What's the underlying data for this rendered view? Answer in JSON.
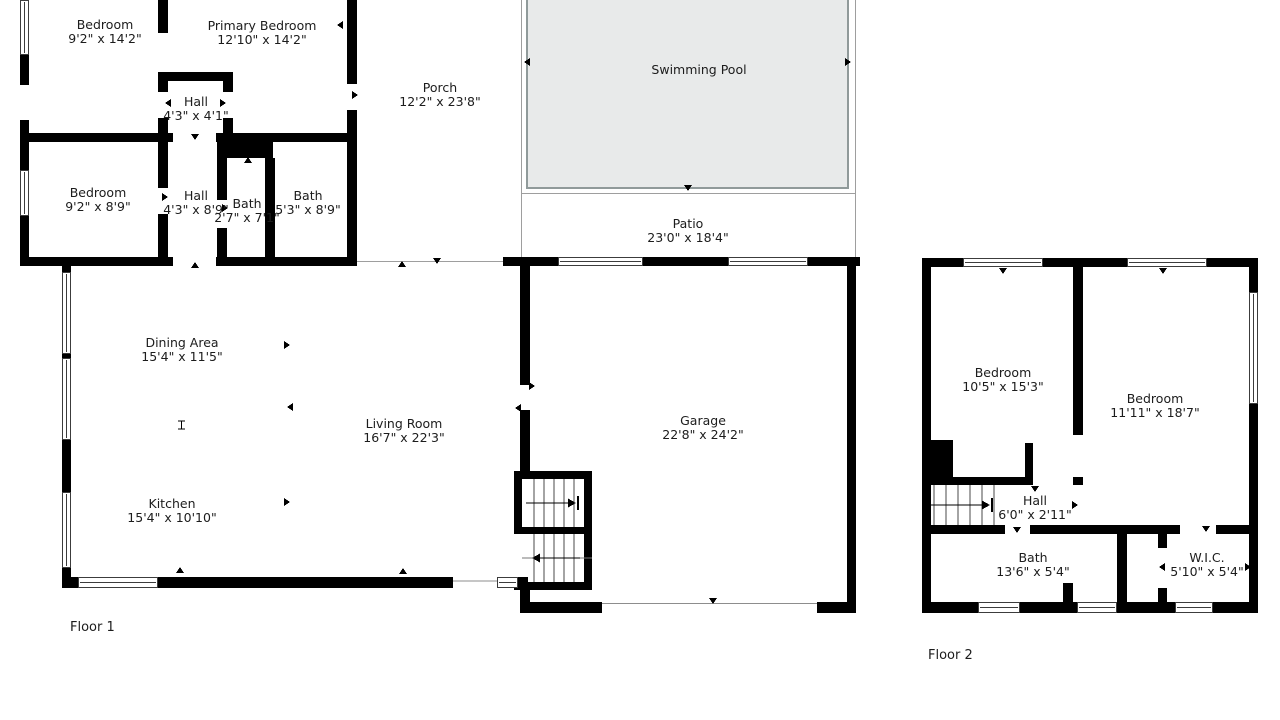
{
  "title": "Floor plan",
  "colors": {
    "wall": "#000000",
    "pool_fill": "#e8eaea",
    "pool_border": "#909a9a",
    "thin_line": "#9e9e9e",
    "text": "#1c1c1c"
  },
  "floor1": {
    "label": "Floor 1",
    "rooms": {
      "bedroom_top": {
        "name": "Bedroom",
        "dims": "9'2\" x 14'2\""
      },
      "primary_bedroom": {
        "name": "Primary Bedroom",
        "dims": "12'10\" x 14'2\""
      },
      "hall_upper": {
        "name": "Hall",
        "dims": "4'3\" x 4'1\""
      },
      "porch": {
        "name": "Porch",
        "dims": "12'2\" x 23'8\""
      },
      "swimming_pool": {
        "name": "Swimming Pool"
      },
      "bedroom_mid": {
        "name": "Bedroom",
        "dims": "9'2\" x 8'9\""
      },
      "hall_lower": {
        "name": "Hall",
        "dims": "4'3\" x 8'9\""
      },
      "bath_small": {
        "name": "Bath",
        "dims": "2'7\" x 7'1\""
      },
      "bath_large": {
        "name": "Bath",
        "dims": "5'3\" x 8'9\""
      },
      "patio": {
        "name": "Patio",
        "dims": "23'0\" x 18'4\""
      },
      "dining_area": {
        "name": "Dining Area",
        "dims": "15'4\" x 11'5\""
      },
      "living_room": {
        "name": "Living Room",
        "dims": "16'7\" x 22'3\""
      },
      "kitchen": {
        "name": "Kitchen",
        "dims": "15'4\" x 10'10\""
      },
      "garage": {
        "name": "Garage",
        "dims": "22'8\" x 24'2\""
      }
    }
  },
  "floor2": {
    "label": "Floor 2",
    "rooms": {
      "bedroom_left": {
        "name": "Bedroom",
        "dims": "10'5\" x 15'3\""
      },
      "bedroom_right": {
        "name": "Bedroom",
        "dims": "11'11\" x 18'7\""
      },
      "hall": {
        "name": "Hall",
        "dims": "6'0\" x 2'11\""
      },
      "bath": {
        "name": "Bath",
        "dims": "13'6\" x 5'4\""
      },
      "wic": {
        "name": "W.I.C.",
        "dims": "5'10\" x 5'4\""
      }
    }
  }
}
